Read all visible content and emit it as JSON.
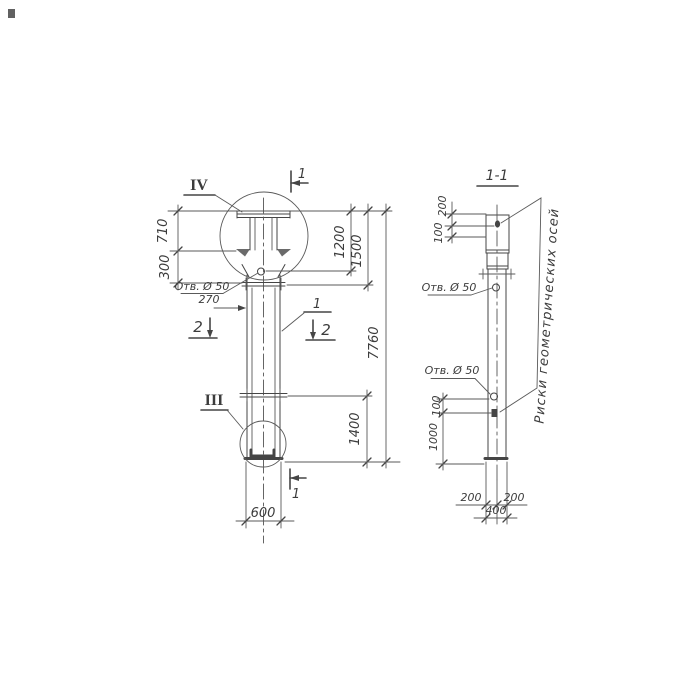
{
  "meta": {
    "background": "#ffffff",
    "ink": "#454545"
  },
  "front_view": {
    "detail_top_label": "IV",
    "detail_bottom_label": "III",
    "position_label": "1",
    "section_cut_top": "1",
    "section_cut_bottom": "1",
    "section_cut_left": "2",
    "section_cut_right": "2",
    "hole_label": "Отв. Ø 50",
    "dims": {
      "d710": "710",
      "d300": "300",
      "d270": "270",
      "d1200": "1200",
      "d1500": "1500",
      "d7760": "7760",
      "d1400": "1400",
      "d600": "600"
    }
  },
  "section_view": {
    "title": "1-1",
    "hole_label_top": "Отв. Ø 50",
    "hole_label_bottom": "Отв. Ø 50",
    "axes_note": "Риски геометрических осей",
    "dims": {
      "d200_top": "200",
      "d100_top": "100",
      "d100_bot": "100",
      "d1000": "1000",
      "d200_left": "200",
      "d200_right": "200",
      "d400": "400"
    }
  }
}
